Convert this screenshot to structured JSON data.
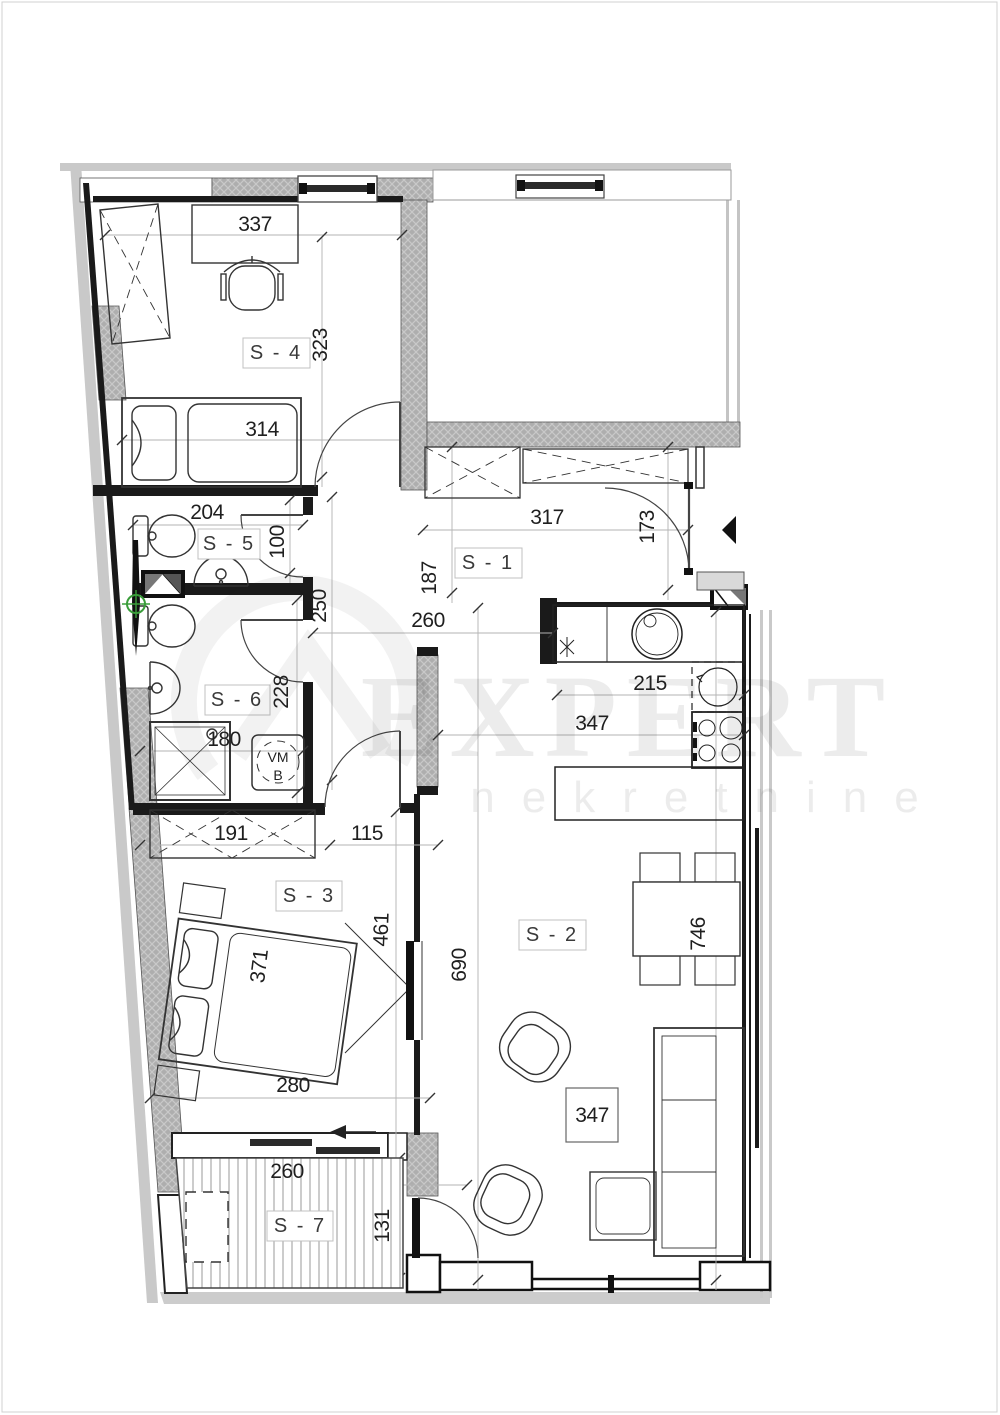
{
  "watermark": {
    "brand": "EXPERT",
    "subtitle": "nekretnine"
  },
  "rooms": {
    "s1": "S - 1",
    "s2": "S - 2",
    "s3": "S - 3",
    "s4": "S - 4",
    "s5": "S - 5",
    "s6": "S - 6",
    "s7": "S - 7"
  },
  "dims": {
    "d337": "337",
    "d323": "323",
    "d314": "314",
    "d204": "204",
    "d100": "100",
    "d250": "250",
    "d187": "187",
    "d317": "317",
    "d173": "173",
    "d260_hall": "260",
    "d228": "228",
    "d180": "180",
    "d215": "215",
    "d347_kitchen": "347",
    "d191": "191",
    "d115": "115",
    "d461": "461",
    "d371": "371",
    "d690": "690",
    "d746": "746",
    "d280": "280",
    "d347_living": "347",
    "d260_terrace": "260",
    "d131": "131"
  },
  "labels": {
    "washing_machine": "VM",
    "washing_machine_b": "B",
    "ac_unit": "AC"
  }
}
